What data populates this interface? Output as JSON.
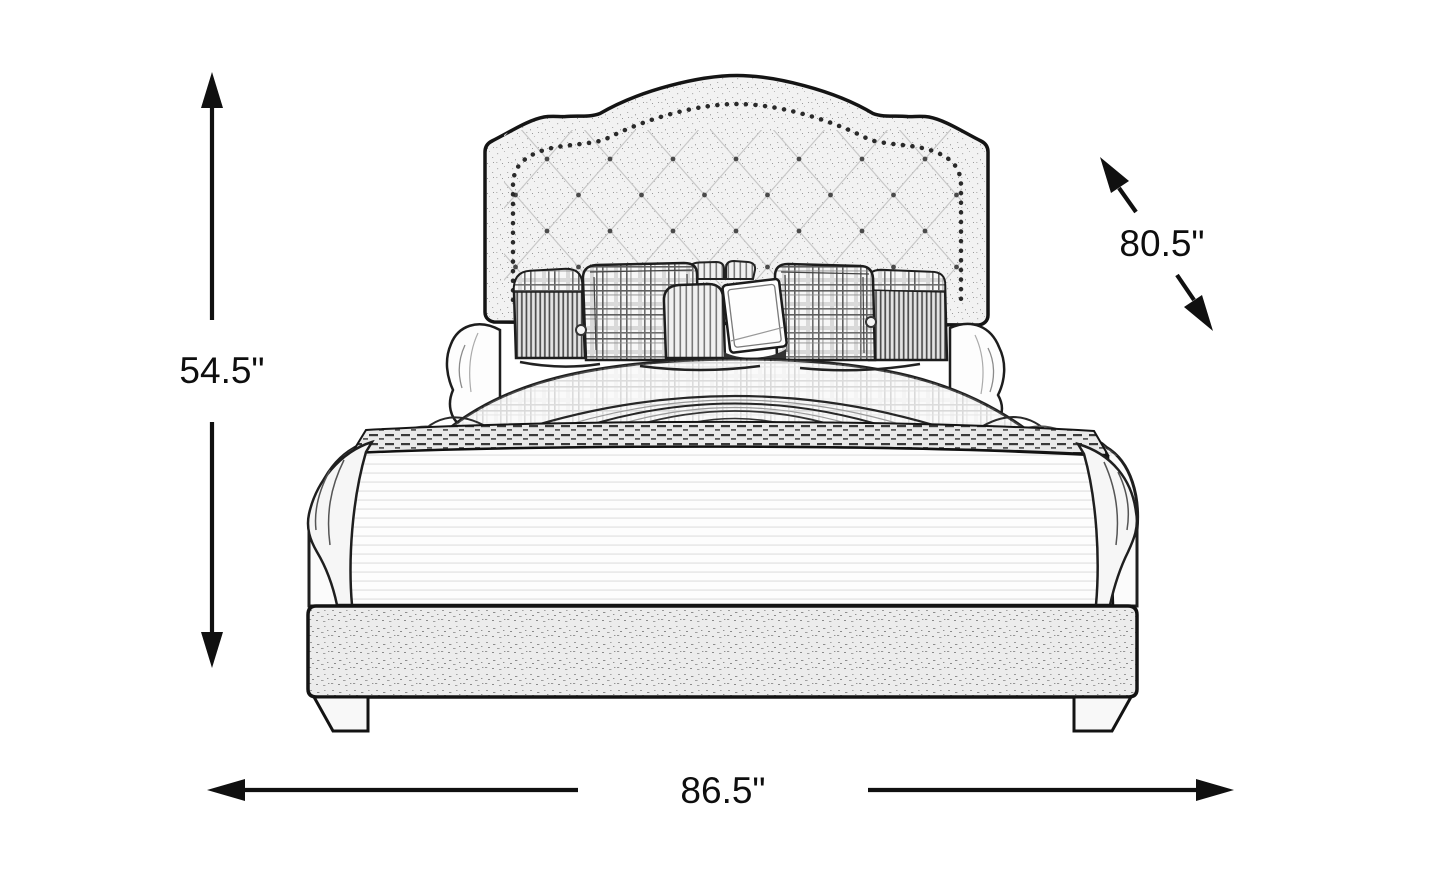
{
  "page": {
    "background": "#ffffff"
  },
  "diagram": {
    "type": "furniture-dimension-diagram",
    "subject": "upholstered panel bed, front view, line-art sketch",
    "dimensions": {
      "height": {
        "label": "54.5\"",
        "orientation": "vertical-left"
      },
      "depth": {
        "label": "80.5\"",
        "orientation": "diagonal-upper-right"
      },
      "width": {
        "label": "86.5\"",
        "orientation": "horizontal-bottom"
      }
    },
    "colors": {
      "line": "#1a1a1a",
      "text": "#0e0e0e",
      "upholstery_light": "#f2f2f2",
      "background": "#ffffff"
    }
  }
}
